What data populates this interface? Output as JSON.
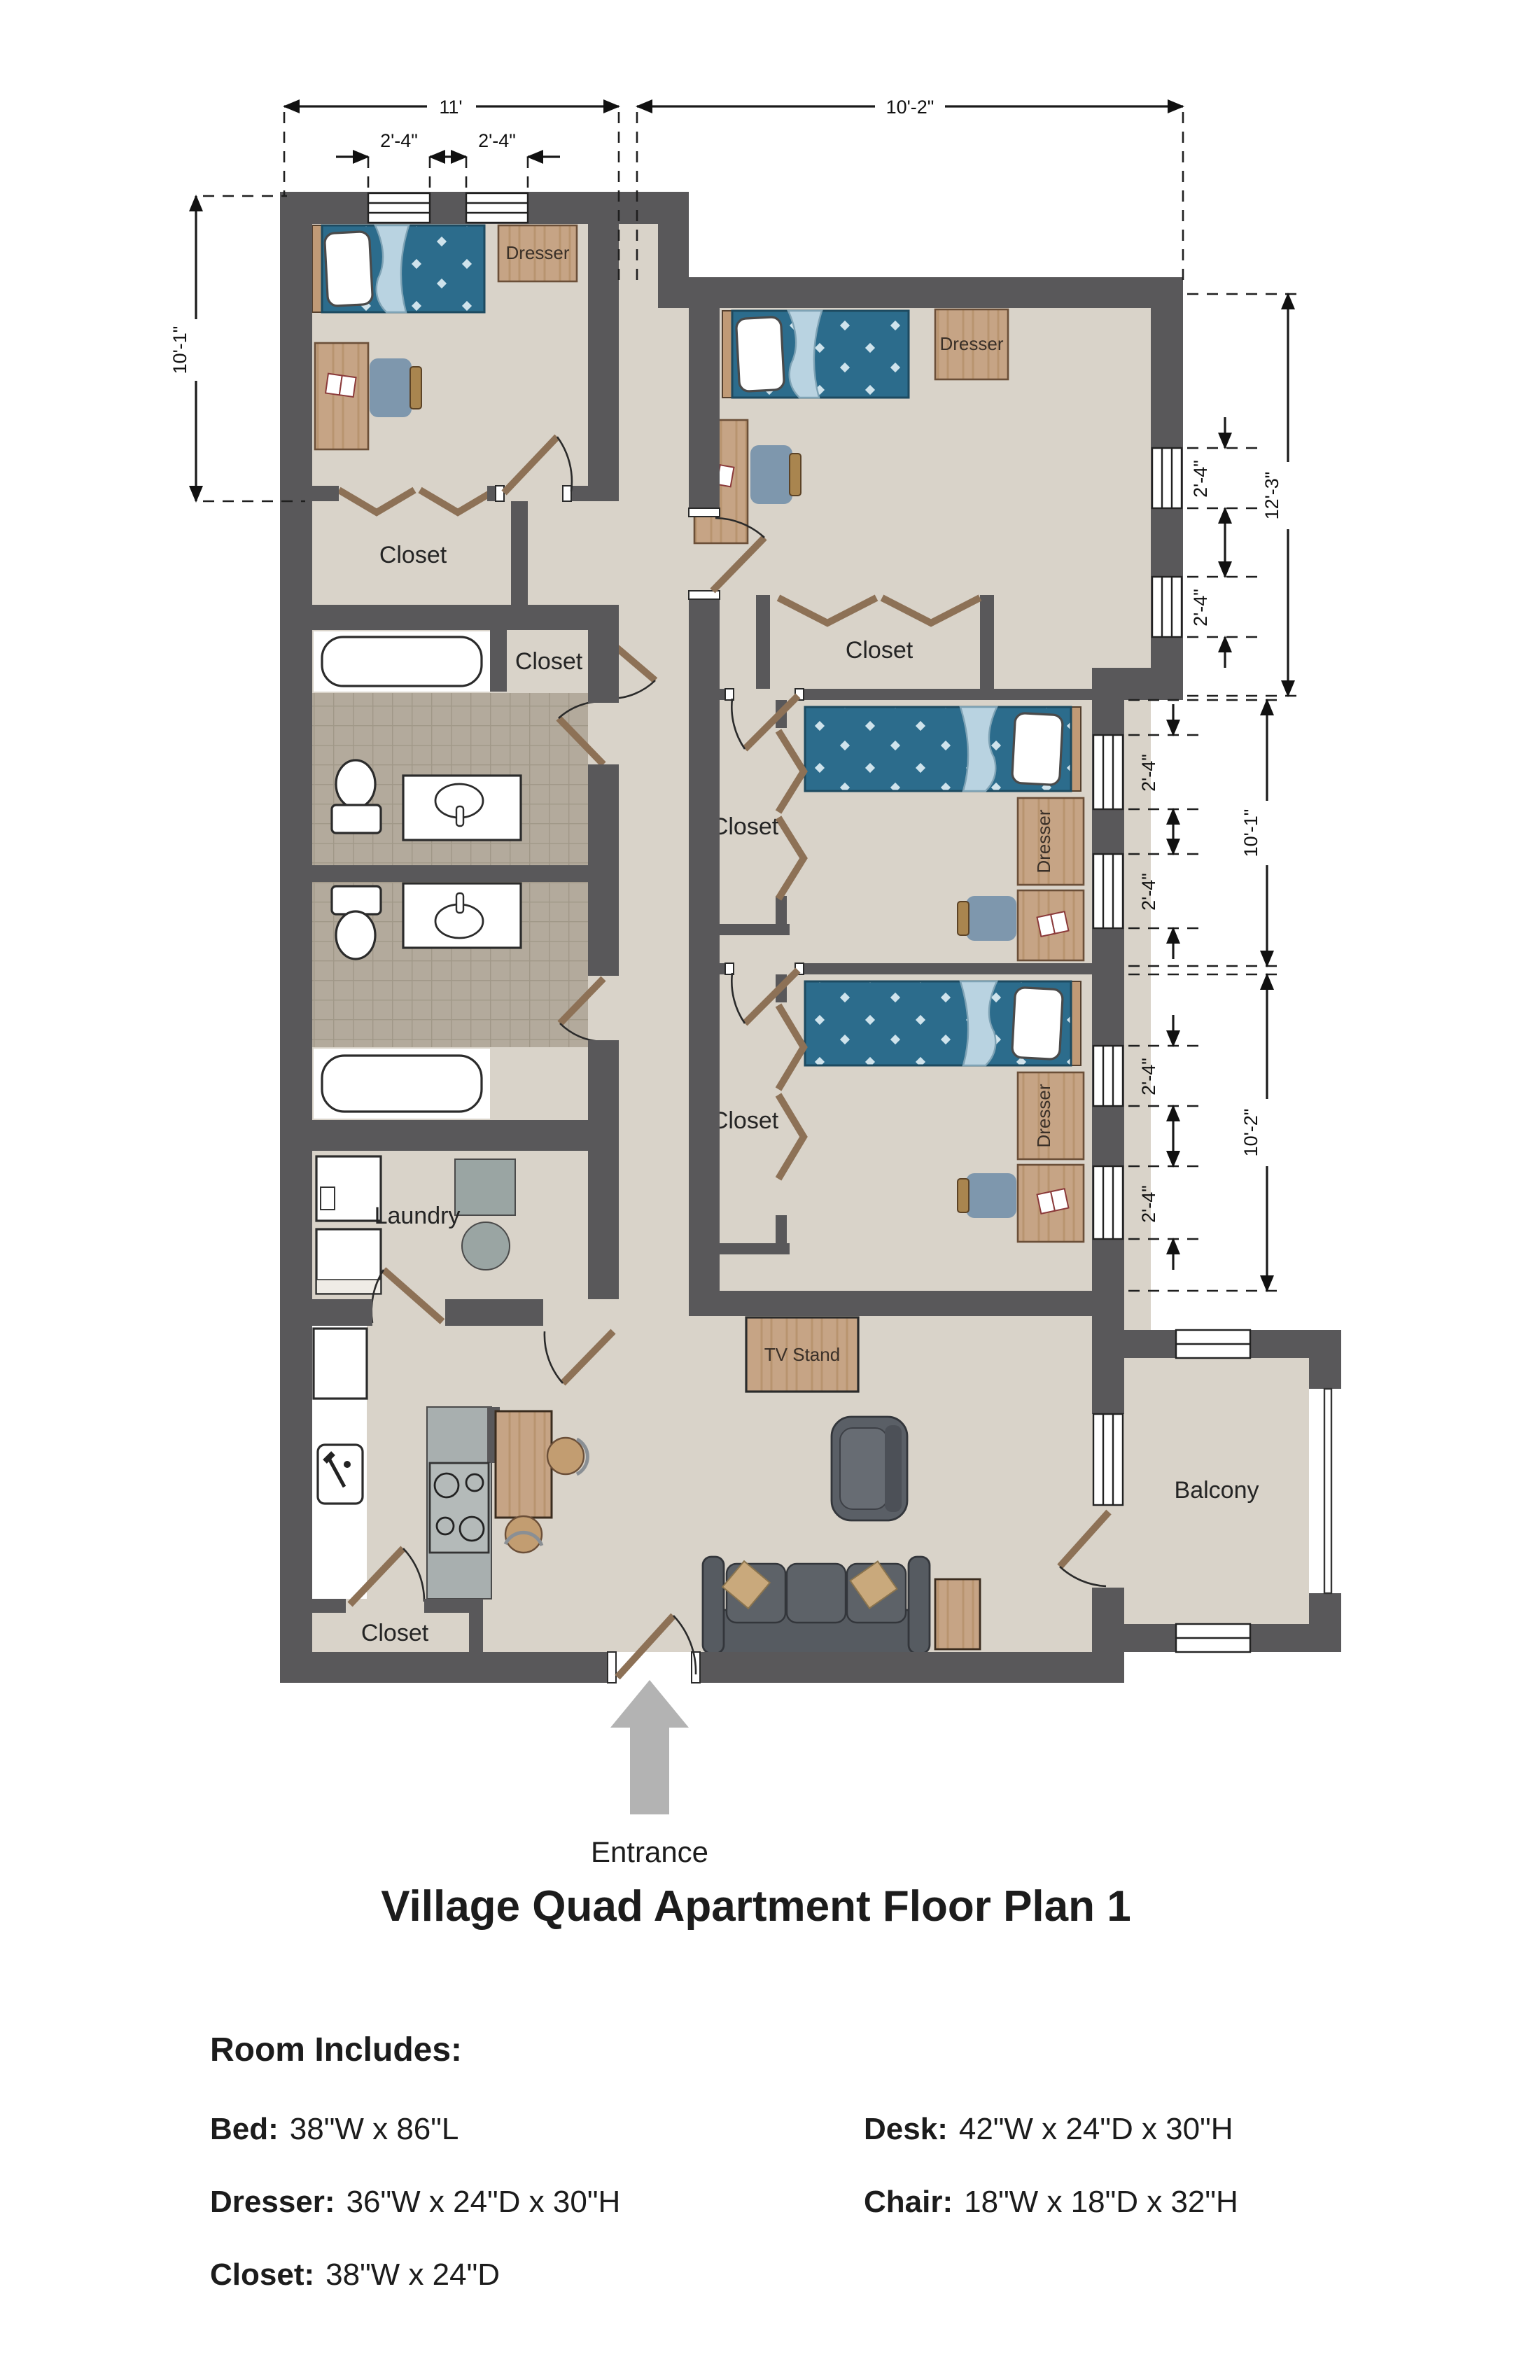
{
  "title": "Village Quad Apartment Floor Plan 1",
  "plan": {
    "labels": {
      "closet": "Closet",
      "laundry": "Laundry",
      "balcony": "Balcony",
      "tv_stand": "TV Stand",
      "dresser": "Dresser",
      "entrance": "Entrance"
    },
    "dims": {
      "w_bedroom1": "11'",
      "w_bedroom2": "10'-2\"",
      "window": "2'-4\"",
      "h_bedroom1": "10'-1\"",
      "h_bedroom2": "12'-3\"",
      "h_bedroom3": "10'-1\"",
      "h_bedroom4": "10'-2\""
    }
  },
  "legend": {
    "heading": "Room Includes:",
    "items": [
      {
        "label": "Bed:",
        "value": "38\"W x 86\"L"
      },
      {
        "label": "Dresser:",
        "value": "36\"W x 24\"D x 30\"H"
      },
      {
        "label": "Closet:",
        "value": "38\"W x 24\"D"
      },
      {
        "label": "Desk:",
        "value": "42\"W x 24\"D x 30\"H"
      },
      {
        "label": "Chair:",
        "value": "18\"W x 18\"D x 32\"H"
      }
    ]
  },
  "colors": {
    "wall": "#59585a",
    "floor": "#d9d3c9",
    "tile": "#b3aa9c",
    "bed_blanket": "#2c6c8c",
    "wood": "#c6a485",
    "sofa": "#54585e",
    "accent_pillow": "#c9a97c",
    "entrance_arrow": "#b3b3b3"
  }
}
